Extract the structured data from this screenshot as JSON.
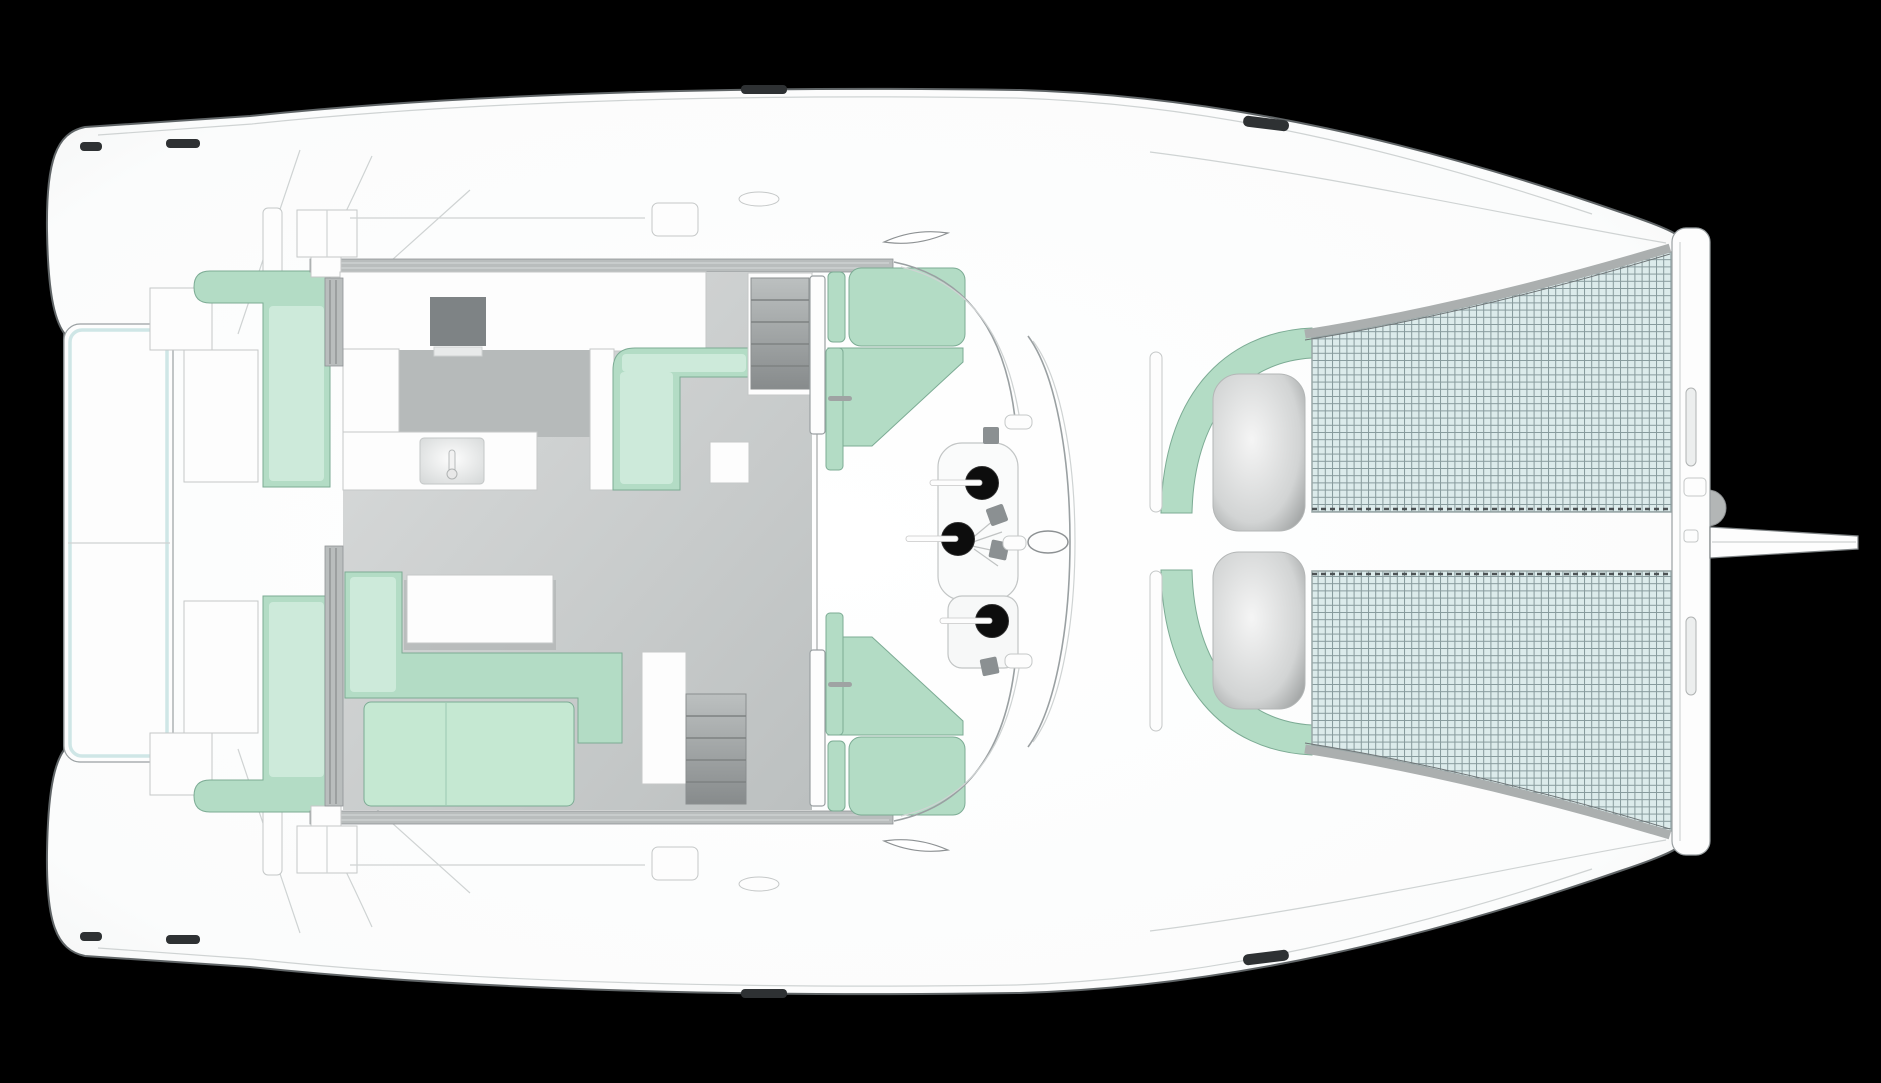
{
  "diagram": {
    "type": "catamaran-deck-plan",
    "view": "top-down",
    "orientation": "bow-right",
    "text_labels": [],
    "areas": [
      "aft-swim-platform",
      "port-transom-steps",
      "starboard-transom-steps",
      "aft-deck",
      "port-aft-sofa",
      "starboard-aft-sofa",
      "saloon",
      "galley",
      "galley-stove",
      "galley-sink",
      "dinette-settee",
      "dinette-table",
      "lounge-sofa",
      "coffee-table",
      "daybed",
      "port-companionway-stairs",
      "starboard-companionway-stairs",
      "sliding-door",
      "forward-cockpit",
      "port-cockpit-bench",
      "starboard-cockpit-bench",
      "helm-winches",
      "mast-foot",
      "foredeck-lounge-port",
      "foredeck-lounge-starboard",
      "sun-pads",
      "port-trampoline",
      "starboard-trampoline",
      "forward-crossbeam",
      "anchor-roller",
      "bowsprit"
    ]
  },
  "palette": {
    "bg": "#000000",
    "hull": "#ffffff",
    "hull-line": "#5f6466",
    "detail": "#9aa0a2",
    "faint": "#cfd3d3",
    "cushion": "#b3dcc5",
    "cushion-light": "#cdeada",
    "cushion-dark": "#8fbfa8",
    "cushion-stroke": "#7cab94",
    "daybed": "#c5e8d2",
    "mesh": "#dcebeb",
    "meshline": "#86999b",
    "platform-edge": "#cfe6e6",
    "floor": "#ccd0d0",
    "galley-floor": "#b6baba",
    "stove": "#7e8385",
    "winch": "#0d0d0d",
    "track": "#b9bdbd",
    "slot": "#2e3133",
    "white": "#fdfdfd"
  }
}
